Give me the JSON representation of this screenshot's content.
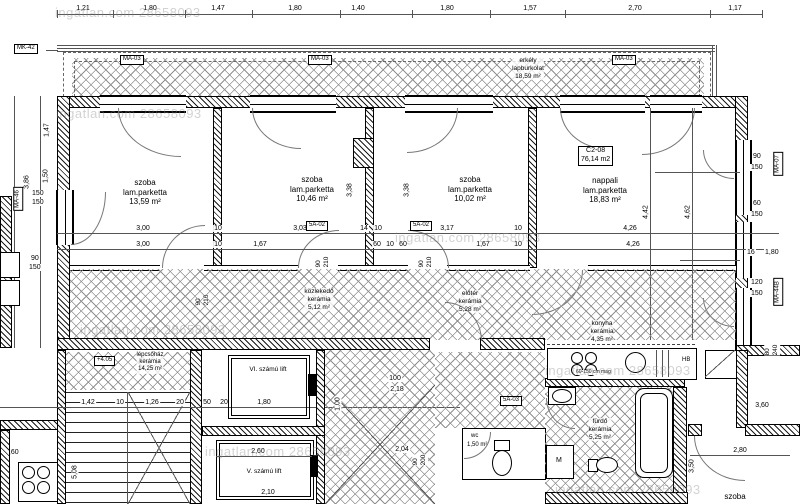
{
  "watermark": "ingatlan.com 28658093",
  "unit": {
    "code": "C2-08",
    "area": "76,14 m2"
  },
  "rooms": {
    "szoba1": {
      "name": "szoba",
      "floor": "lam.parketta",
      "area": "13,59 m²"
    },
    "szoba2": {
      "name": "szoba",
      "floor": "lam.parketta",
      "area": "10,46 m²"
    },
    "szoba3": {
      "name": "szoba",
      "floor": "lam.parketta",
      "area": "10,02 m²"
    },
    "nappali": {
      "name": "nappali",
      "floor": "lam.parketta",
      "area": "18,83 m²"
    },
    "erkely": {
      "name": "erkély",
      "floor": "lapburkolat",
      "area": "18,59 m²"
    },
    "kozlekedo": {
      "name": "közlekedő",
      "floor": "kerámia",
      "area": "5,12 m²"
    },
    "eloter": {
      "name": "előtér",
      "floor": "kerámia",
      "area": "5,28 m²"
    },
    "konyha": {
      "name": "konyha",
      "floor": "kerámia",
      "area": "4,35 m²"
    },
    "furdo": {
      "name": "fürdő",
      "floor": "kerámia",
      "area": "5,25 m²"
    },
    "wc": {
      "name": "wc",
      "area": "1,50 m²"
    },
    "lepcsohaz": {
      "name": "lépcsőház",
      "floor": "kerámia",
      "area": "14,25 m²"
    },
    "lift6": {
      "name": "VI. számú lift"
    },
    "lift5": {
      "name": "V. számú lift"
    },
    "szoba_dk": {
      "name": "szoba"
    }
  },
  "markers": {
    "mk42": "MK-42",
    "ma03": "MA-03",
    "ma07": "MA-07",
    "ma44": "MA-44B",
    "ma46": "MA-46",
    "sa02": "5A-02",
    "sa03": "5A-03",
    "elev": "+4.05",
    "hb": "HB",
    "m": "M"
  },
  "dims": {
    "top": [
      "1,21",
      "1,80",
      "1,47",
      "1,80",
      "1,40",
      "1,80",
      "1,57",
      "2,70",
      "1,17"
    ],
    "mid_a": [
      "3,00",
      "10",
      "3,03",
      "14",
      "10",
      "3,17",
      "10",
      "4,26"
    ],
    "mid_b": [
      "3,00",
      "10",
      "1,67",
      "60",
      "10",
      "60",
      "1,67",
      "10",
      "4,26"
    ],
    "doors": {
      "w": "90",
      "h": "210",
      "h2": "200"
    },
    "left": {
      "v1": "1,47",
      "v2": "1,50",
      "v3": "3,86",
      "w1a": "150",
      "w1b": "150",
      "w2a": "90",
      "w2b": "150"
    },
    "right": {
      "w1a": "90",
      "w1b": "150",
      "w2a": "60",
      "w2b": "150",
      "w3a": "120",
      "w3b": "150",
      "gap": "16",
      "len": "1,80",
      "sa": "80",
      "sb": "240"
    },
    "rooms": {
      "r2v": "3,38",
      "r3v": "3,38",
      "n1": "4,42",
      "n2": "4,62"
    },
    "stairs": [
      "1,42",
      "10",
      "1,26",
      "20"
    ],
    "stairs_w": "1,60",
    "stairs_h": "5,08",
    "lift6": "1,80",
    "lift5_w": "2,60",
    "lift5_d": "2,10",
    "la": "50",
    "lb": "20",
    "shaft_a": "100",
    "shaft_b": "2,18",
    "shaft_c": "1,00",
    "shaft_d": "2,04",
    "dk_w": "2,80",
    "dk_h": "3,50",
    "dk_door": "3,60",
    "note": "60-150 cm mag"
  }
}
